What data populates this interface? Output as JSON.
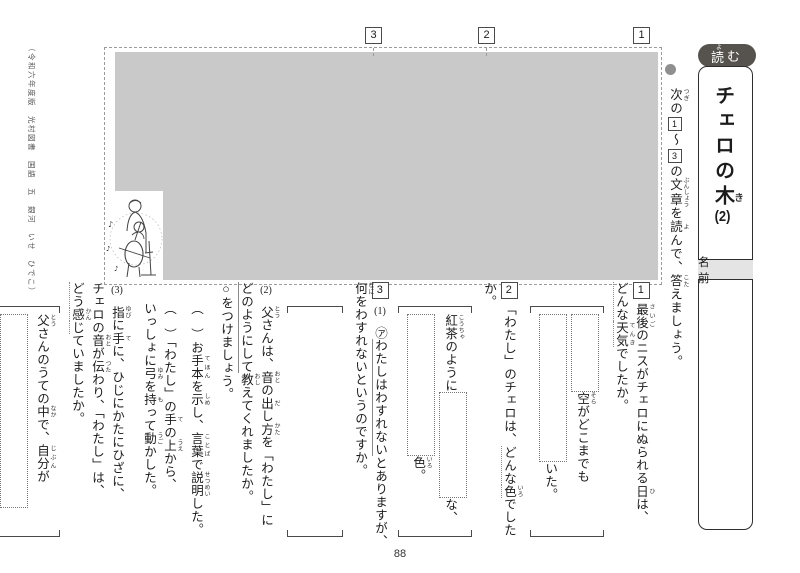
{
  "page": {
    "number": "88",
    "copyright": "（令和六年度版　光村図書　国語　五　銀河　いせ　ひでこ）"
  },
  "colors": {
    "badge_bg": "#56534e",
    "passage_fill": "#c9c9c9",
    "name_strip_bg": "#e4e4e4"
  },
  "icons": {
    "bullet": "●",
    "music_note": "♪"
  },
  "header": {
    "badge_segments": [
      {
        "t": "読",
        "r": "よ"
      },
      {
        "t": "む"
      }
    ],
    "title_segments": [
      {
        "t": "チェロの"
      },
      {
        "t": "木",
        "r": "き"
      },
      {
        "t": "(2)",
        "tcy": true
      }
    ],
    "name_label": "名　前"
  },
  "instruction": {
    "bullet": "●",
    "segments": [
      {
        "t": "次",
        "r": "つぎ"
      },
      {
        "t": "の"
      },
      {
        "t": "1",
        "box": true
      },
      {
        "t": "〜"
      },
      {
        "t": "3",
        "box": true
      },
      {
        "t": "の"
      },
      {
        "t": "文章",
        "r": "ぶんしょう"
      },
      {
        "t": "を"
      },
      {
        "t": "読",
        "r": "よ"
      },
      {
        "t": "んで、"
      },
      {
        "t": "答",
        "r": "こた"
      },
      {
        "t": "えましょう。"
      }
    ]
  },
  "passage": {
    "section_markers": [
      "3",
      "2",
      "1"
    ]
  },
  "questions": [
    {
      "num": "1",
      "text": [
        {
          "t": "最後",
          "r": "さいご"
        },
        {
          "t": "のニスがチェロにぬられる"
        },
        {
          "t": "日",
          "r": "ひ"
        },
        {
          "t": "は、"
        },
        {
          "br": true
        },
        {
          "t": "どんな",
          "em": "dotted"
        },
        {
          "t": "天気",
          "r": "てんき",
          "em": "dotted"
        },
        {
          "t": "でしたか。"
        }
      ],
      "answer": {
        "columns": [
          [
            {
              "type": "box",
              "h": 76
            },
            {
              "type": "text",
              "segments": [
                {
                  "t": "空",
                  "r": "そら"
                },
                {
                  "t": "がどこまでも"
                }
              ]
            }
          ],
          [
            {
              "type": "box",
              "h": 146
            },
            {
              "type": "text",
              "segments": [
                {
                  "t": "いた。"
                }
              ]
            }
          ]
        ]
      }
    },
    {
      "num": "2",
      "text": [
        {
          "t": "「わたし」のチェロは、"
        },
        {
          "t": "どんな",
          "em": "dotted"
        },
        {
          "t": "色",
          "r": "いろ",
          "em": "dotted"
        },
        {
          "t": "でしたか。"
        }
      ],
      "answer": {
        "columns": [
          [
            {
              "type": "text",
              "segments": [
                {
                  "t": "紅茶",
                  "r": "こうちゃ"
                },
                {
                  "t": "のように"
                }
              ]
            },
            {
              "type": "box",
              "h": 104
            },
            {
              "type": "text",
              "segments": [
                {
                  "t": "な、"
                }
              ]
            }
          ],
          [
            {
              "type": "box",
              "h": 140
            },
            {
              "type": "text",
              "segments": [
                {
                  "t": "色",
                  "r": "いろ"
                },
                {
                  "t": "。"
                }
              ]
            }
          ]
        ]
      }
    },
    {
      "num": "3",
      "subs": [
        {
          "label": "(1)",
          "text": [
            {
              "t": "㋐"
            },
            {
              "t": "わたしはわすれない",
              "em": "solid"
            },
            {
              "t": "とありますが、"
            },
            {
              "br": true
            },
            {
              "t": "何",
              "r": "なに"
            },
            {
              "t": "をわすれないというのですか。"
            }
          ],
          "answer": {
            "empty": true,
            "width": 46
          }
        },
        {
          "label": "(2)",
          "text": [
            {
              "t": "父",
              "r": "とう"
            },
            {
              "t": "さんは、"
            },
            {
              "t": "音",
              "r": "おと"
            },
            {
              "t": "の"
            },
            {
              "t": "出",
              "r": "だ"
            },
            {
              "t": "し"
            },
            {
              "t": "方",
              "r": "かた"
            },
            {
              "t": "を「わたし」に"
            },
            {
              "br": true
            },
            {
              "t": "どのようにして",
              "em": "solid"
            },
            {
              "t": "教",
              "r": "おし"
            },
            {
              "t": "えてくれましたか。"
            },
            {
              "br": true
            },
            {
              "t": "○をつけましょう。"
            }
          ],
          "options": [
            {
              "segments": [
                {
                  "t": "（　）お"
                },
                {
                  "t": "手本",
                  "r": "てほん"
                },
                {
                  "t": "を"
                },
                {
                  "t": "示",
                  "r": "しめ"
                },
                {
                  "t": "し、"
                },
                {
                  "t": "言葉",
                  "r": "ことば"
                },
                {
                  "t": "で"
                },
                {
                  "t": "説明",
                  "r": "せつめい"
                },
                {
                  "t": "した。"
                }
              ]
            },
            {
              "segments": [
                {
                  "t": "（　）「わたし」の"
                },
                {
                  "t": "手",
                  "r": "て"
                },
                {
                  "t": "の"
                },
                {
                  "t": "上",
                  "r": "うえ"
                },
                {
                  "t": "から、"
                },
                {
                  "br": true
                },
                {
                  "t": "いっしょに"
                },
                {
                  "t": "弓",
                  "r": "ゆみ"
                },
                {
                  "t": "を"
                },
                {
                  "t": "持",
                  "r": "も"
                },
                {
                  "t": "って"
                },
                {
                  "t": "動",
                  "r": "うご"
                },
                {
                  "t": "かした。"
                }
              ]
            }
          ]
        },
        {
          "label": "(3)",
          "text": [
            {
              "t": "指",
              "r": "ゆび"
            },
            {
              "t": "に"
            },
            {
              "t": "手",
              "r": "て"
            },
            {
              "t": "に、ひじにかたにひざに、"
            },
            {
              "br": true
            },
            {
              "t": "チェロの"
            },
            {
              "t": "音",
              "r": "おと"
            },
            {
              "t": "が"
            },
            {
              "t": "伝",
              "r": "つた"
            },
            {
              "t": "わり、「わたし」は、"
            },
            {
              "br": true
            },
            {
              "t": "どう",
              "em": "dotted"
            },
            {
              "t": "感",
              "r": "かん",
              "em": "dotted"
            },
            {
              "t": "じ",
              "em": "dotted"
            },
            {
              "t": "ていましたか。"
            }
          ],
          "answer": {
            "columns": [
              [
                {
                  "type": "text",
                  "segments": [
                    {
                      "t": "父",
                      "r": "とう"
                    },
                    {
                      "t": "さんのうての"
                    },
                    {
                      "t": "中",
                      "r": "なか"
                    },
                    {
                      "t": "で、"
                    },
                    {
                      "t": "自分",
                      "r": "じぶん"
                    },
                    {
                      "t": "が"
                    }
                  ]
                }
              ],
              [
                {
                  "type": "box",
                  "h": 192
                }
              ],
              [
                {
                  "type": "text",
                  "segments": [
                    {
                      "t": "ような"
                    },
                    {
                      "t": "気",
                      "r": "き"
                    },
                    {
                      "t": "がしていた。"
                    }
                  ]
                }
              ]
            ]
          }
        }
      ]
    }
  ]
}
